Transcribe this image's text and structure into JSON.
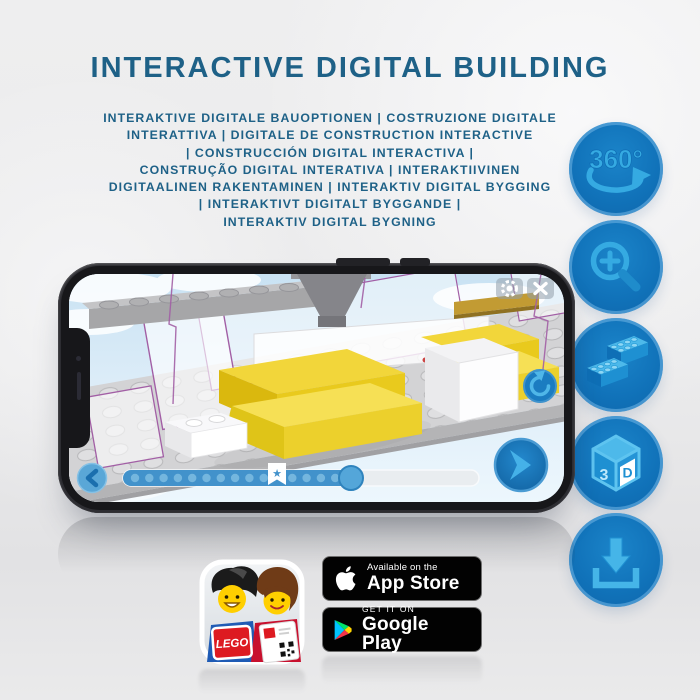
{
  "header": {
    "title": "INTERACTIVE DIGITAL BUILDING",
    "subtitle_lines": [
      "INTERAKTIVE DIGITALE BAUOPTIONEN | COSTRUZIONE DIGITALE",
      "INTERATTIVA | DIGITALE DE CONSTRUCTION INTERACTIVE",
      "| CONSTRUCCIÓN DIGITAL INTERACTIVA |",
      "CONSTRUÇÃO DIGITAL INTERATIVA | INTERAKTIIVINEN",
      "DIGITAALINEN RAKENTAMINEN | INTERAKTIV DIGITAL BYGGING",
      "| INTERAKTIVT DIGITALT BYGGANDE |",
      "INTERAKTIV DIGITAL BYGNING"
    ]
  },
  "features": {
    "rotation_label": "360°",
    "cube_left": "3",
    "cube_right": "D",
    "items": [
      {
        "name": "360-rotation-icon"
      },
      {
        "name": "zoom-in-icon"
      },
      {
        "name": "lego-bricks-icon"
      },
      {
        "name": "3d-view-icon"
      },
      {
        "name": "download-icon"
      }
    ]
  },
  "phone": {
    "screen": {
      "controls": [
        "settings",
        "close",
        "rotate-reset",
        "previous-step",
        "next-step"
      ],
      "slider": {
        "progress_percent": 63,
        "bookmark_star": "★"
      }
    }
  },
  "store": {
    "app_store": {
      "line1": "Available on the",
      "line2": "App Store"
    },
    "google_play": {
      "line1": "GET IT ON",
      "line2": "Google Play"
    },
    "lego_logo": "LEGO"
  },
  "colors": {
    "title_blue": "#1e6187",
    "circle_blue": "#1173ba",
    "icon_blue": "#2ea7e0",
    "lego_yellow": "#f2d63a",
    "badge_black": "#020202"
  }
}
